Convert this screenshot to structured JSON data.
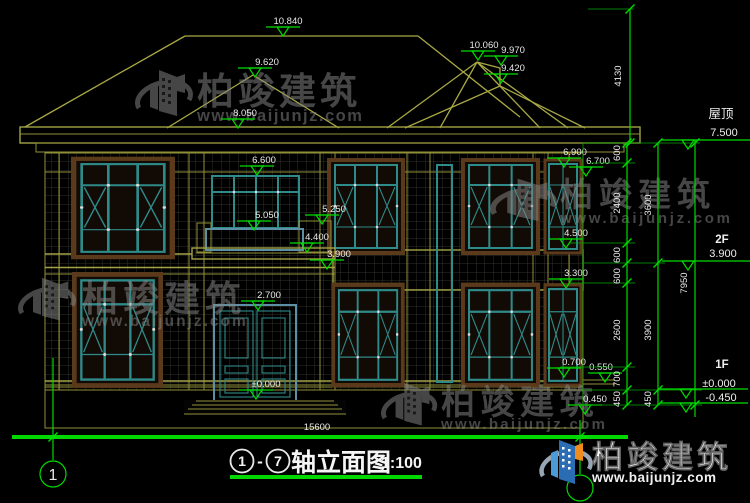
{
  "drawing": {
    "title": {
      "axis_start": "1",
      "dash": "-",
      "axis_end": "7",
      "name": "轴立面图",
      "scale": "1:100"
    },
    "axis": {
      "left_bubble": "1"
    }
  },
  "elevations": {
    "ridge_main": "10.840",
    "hip_front": "9.620",
    "eave_main": "8.050",
    "tower_top": "10.060",
    "tower_mid": "9.970",
    "tower_low": "9.420",
    "frieze": "6.600",
    "balcony_rail": "5.050",
    "pier_top": "5.250",
    "balcony_slab": "4.400",
    "floor2": "3.900",
    "door_head": "2.700",
    "door_zero": "±0.000",
    "eave_right_a": "6.900",
    "eave_right_b": "6.700",
    "sill2f_right": "4.500",
    "band_right": "3.300",
    "plinth_a": "0.700",
    "plinth_b": "0.550",
    "plinth_c": "0.450"
  },
  "right_levels": {
    "roof_label": "屋顶",
    "roof": "7.500",
    "f2_label": "2F",
    "f2": "3.900",
    "f1_label": "1F",
    "f1_zero": "±0.000",
    "f1_below": "-0.450"
  },
  "vdims": {
    "roof": "4130",
    "a1": "600",
    "a2": "2400",
    "a3": "600",
    "a4": "600",
    "a5": "2600",
    "a6": "700",
    "a7": "450",
    "b1": "3600",
    "b2": "3900",
    "b3": "450",
    "total": "7950"
  },
  "hdims": {
    "total": "15600"
  },
  "branding": {
    "name": "柏竣建筑",
    "url": "www.baijunjz.com"
  },
  "colors": {
    "background": "#000000",
    "cad_green": "#00dc00",
    "roof_khaki": "#a8a845",
    "window_teal": "#2f8a8a",
    "frame_steel": "#5d90a5",
    "text_white": "#e9e9e9",
    "watermark_gray": "#868686",
    "logo_blue": "#2a6db5",
    "logo_light_blue": "#4b9bd8",
    "logo_orange": "#f08c1e"
  }
}
